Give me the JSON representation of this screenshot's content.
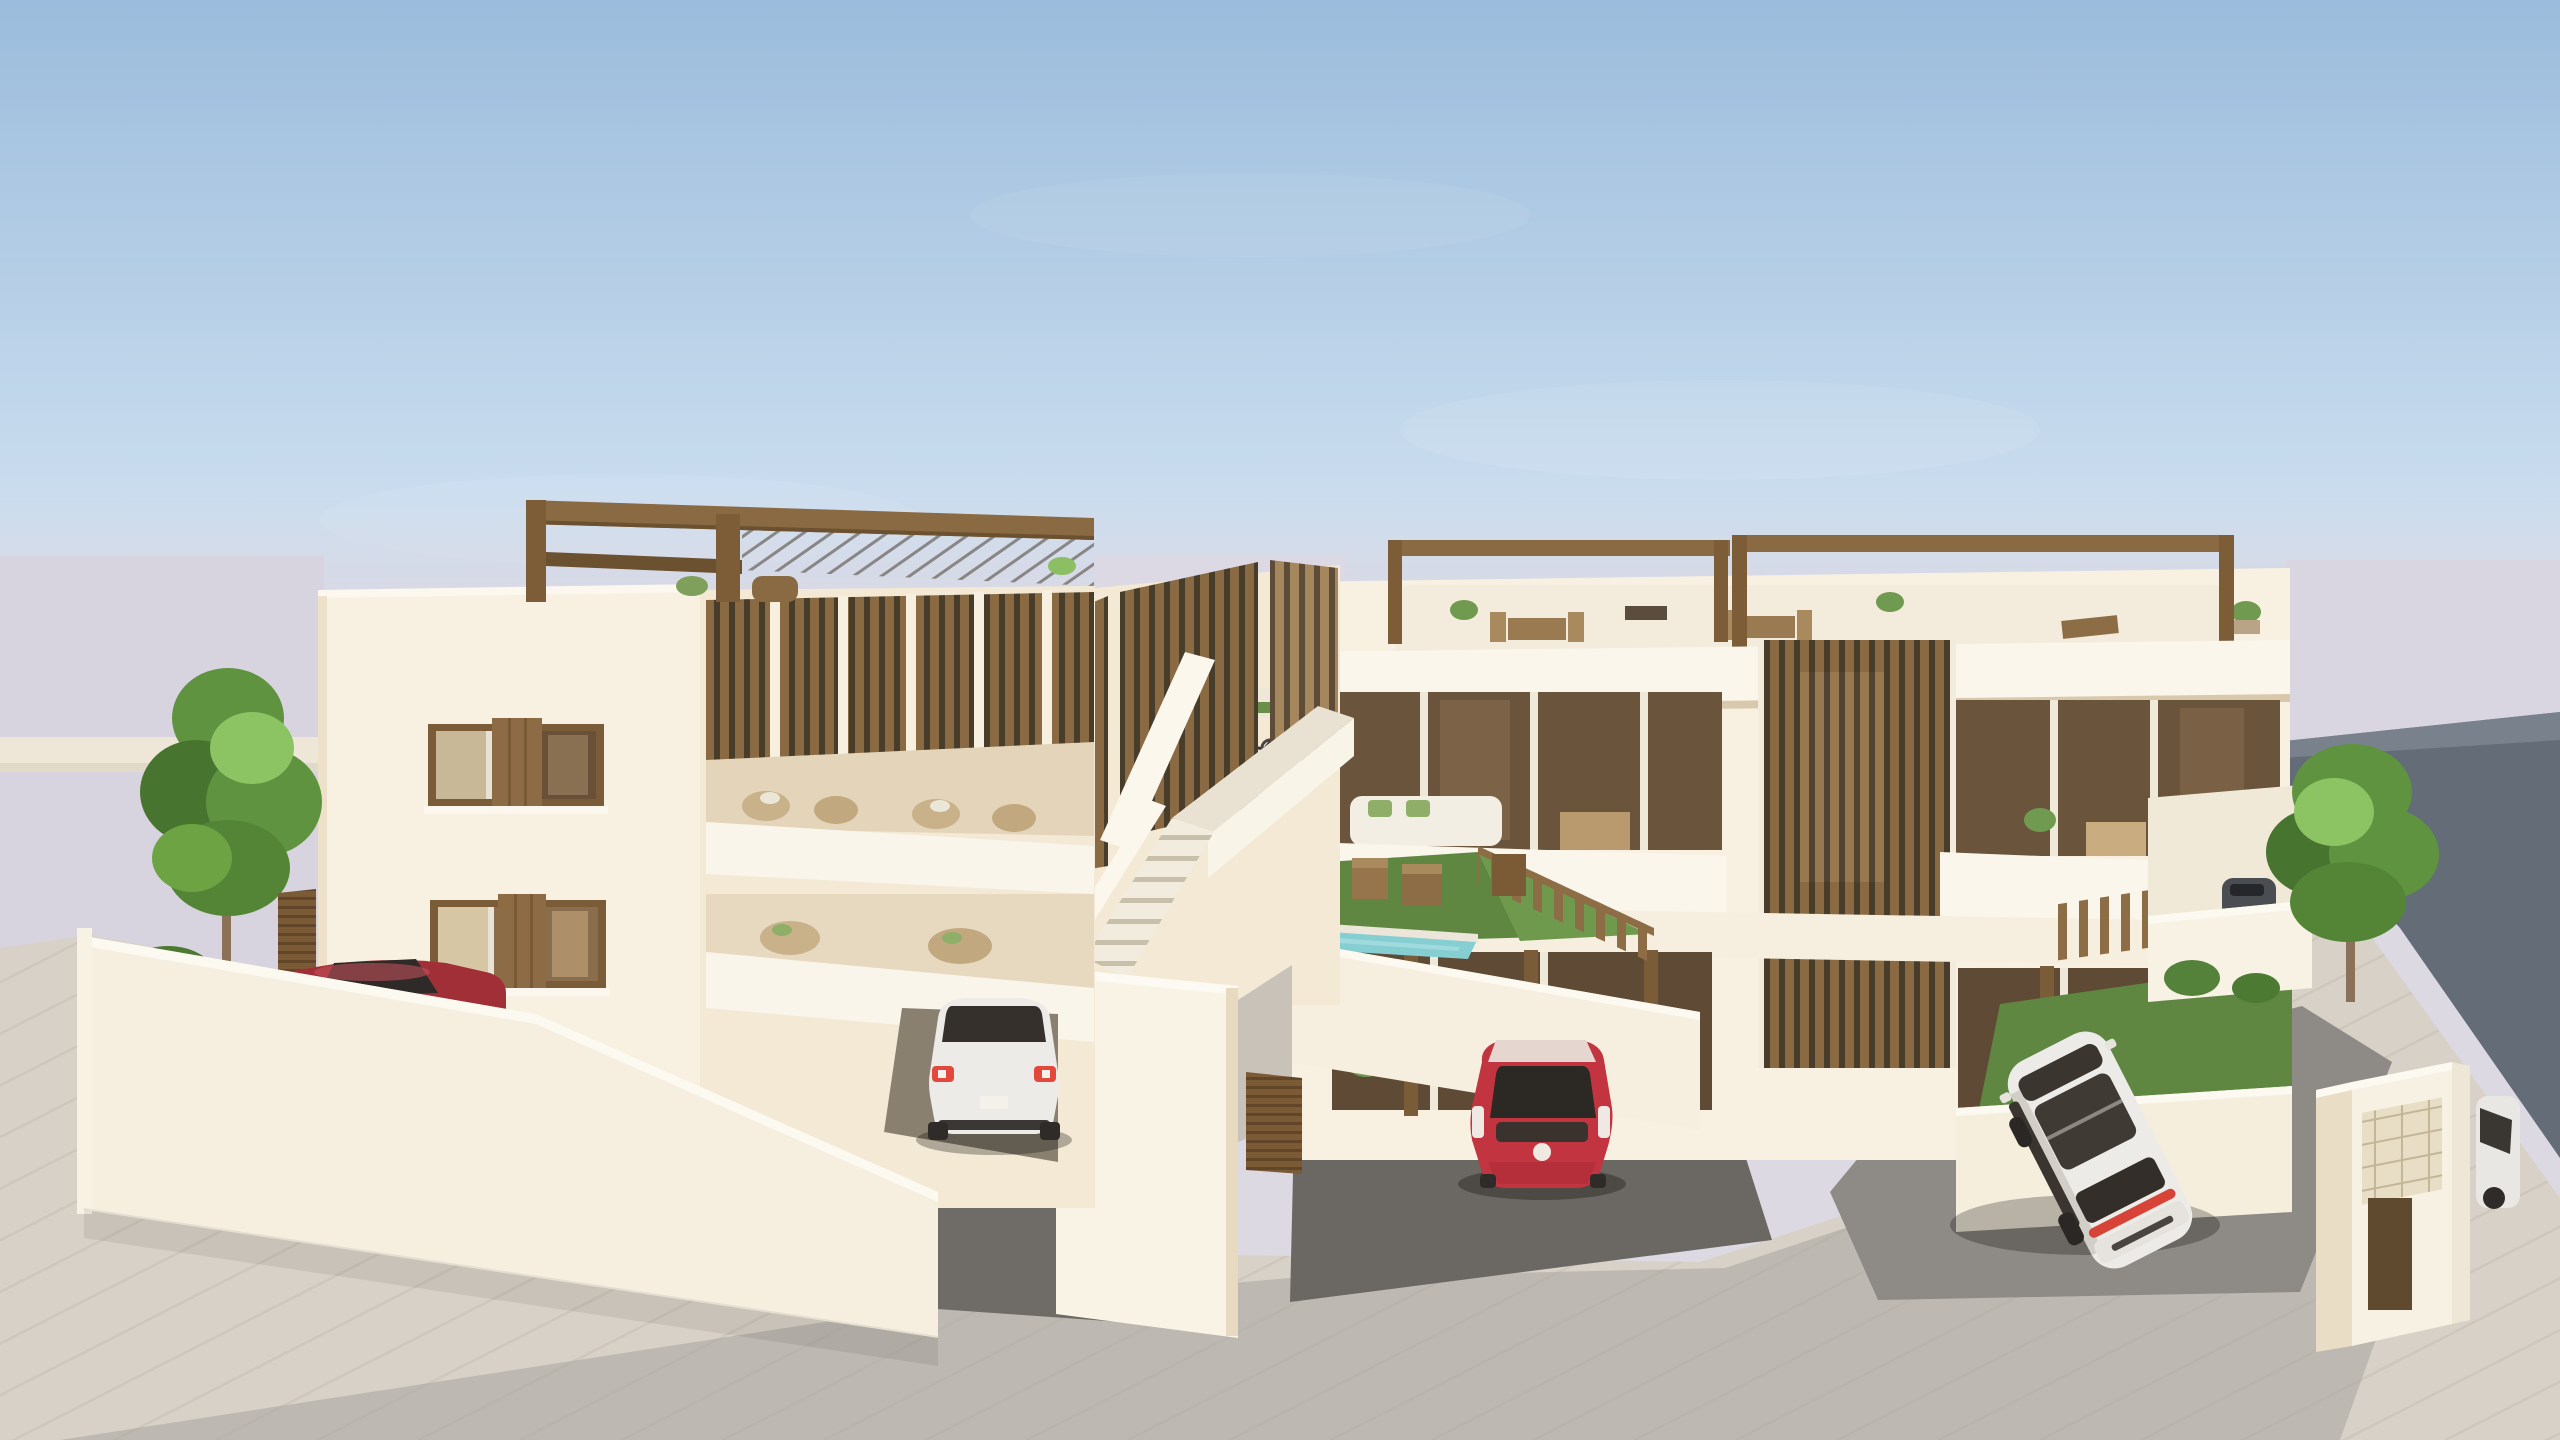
{
  "scene": {
    "type": "architectural-3d-render",
    "description": "3D architectural rendering of a modern white apartment complex with wooden louver accents, rooftop pergolas, balconies with outdoor furniture, a small swimming pool and lawn behind a picket fence, parked cars on gray driveways and a pale paved street, young green trees, and a dark hillside plot under a hazy blue sky.",
    "objects": [
      "sky",
      "horizon-haze",
      "left-apartment-building",
      "right-apartment-building",
      "rooftop-pergola",
      "wooden-louver-screens",
      "central-staircase",
      "walkway-ramp",
      "perimeter-walls",
      "garden-gate",
      "garage-door",
      "swimming-pool",
      "lawn",
      "wood-picket-fence",
      "sun-loungers",
      "balcony-furniture",
      "bicycles",
      "left-tree",
      "right-tree",
      "shrubs",
      "white-sedan",
      "red-hatchback",
      "white-suv",
      "dark-red-coupe",
      "parked-dark-car",
      "white-car-front",
      "mailbox-unit",
      "asphalt-driveways",
      "paved-sidewalk",
      "street",
      "hillside-slope"
    ]
  },
  "colors": {
    "sky_top": "#9bbcdc",
    "sky_mid": "#c9dcee",
    "sky_low": "#e9edf2",
    "haze": "#dad7e3",
    "distant": "#d7d4e0",
    "distant_wall": "#eee7d8",
    "slope": "#636c77",
    "slope_light": "#79828c",
    "building": "#f8f1e2",
    "building_flank": "#f3e9d5",
    "building_shade": "#e8dac0",
    "parapet": "#fbf6ec",
    "wood": "#8a6a42",
    "wood_dark": "#6b5130",
    "wood_light": "#a6865c",
    "louver_gap": "#483c2b",
    "glass": "#6b543c",
    "glass_dark": "#46382a",
    "glass_light": "#c9b897",
    "shutter": "#8d6b44",
    "road": "#a8a49f",
    "sidewalk": "#d8d1c8",
    "sidewalk_joint": "#c6beb3",
    "driveway": "#6f6b66",
    "driveway_light": "#8e8a85",
    "lawn": "#5f8742",
    "lawn_light": "#6f9a4e",
    "pool": "#85ced2",
    "pool_edge": "#ece6da",
    "tree": "#5f9340",
    "tree_dark": "#47742e",
    "tree_light": "#8cc363",
    "trunk": "#8a7157",
    "fence": "#8d6d46",
    "car_white": "#edebe7",
    "car_red": "#c23440",
    "car_dark_red": "#a12f38",
    "taillight": "#e2483c",
    "shadow": "rgba(0,0,0,0.28)"
  }
}
